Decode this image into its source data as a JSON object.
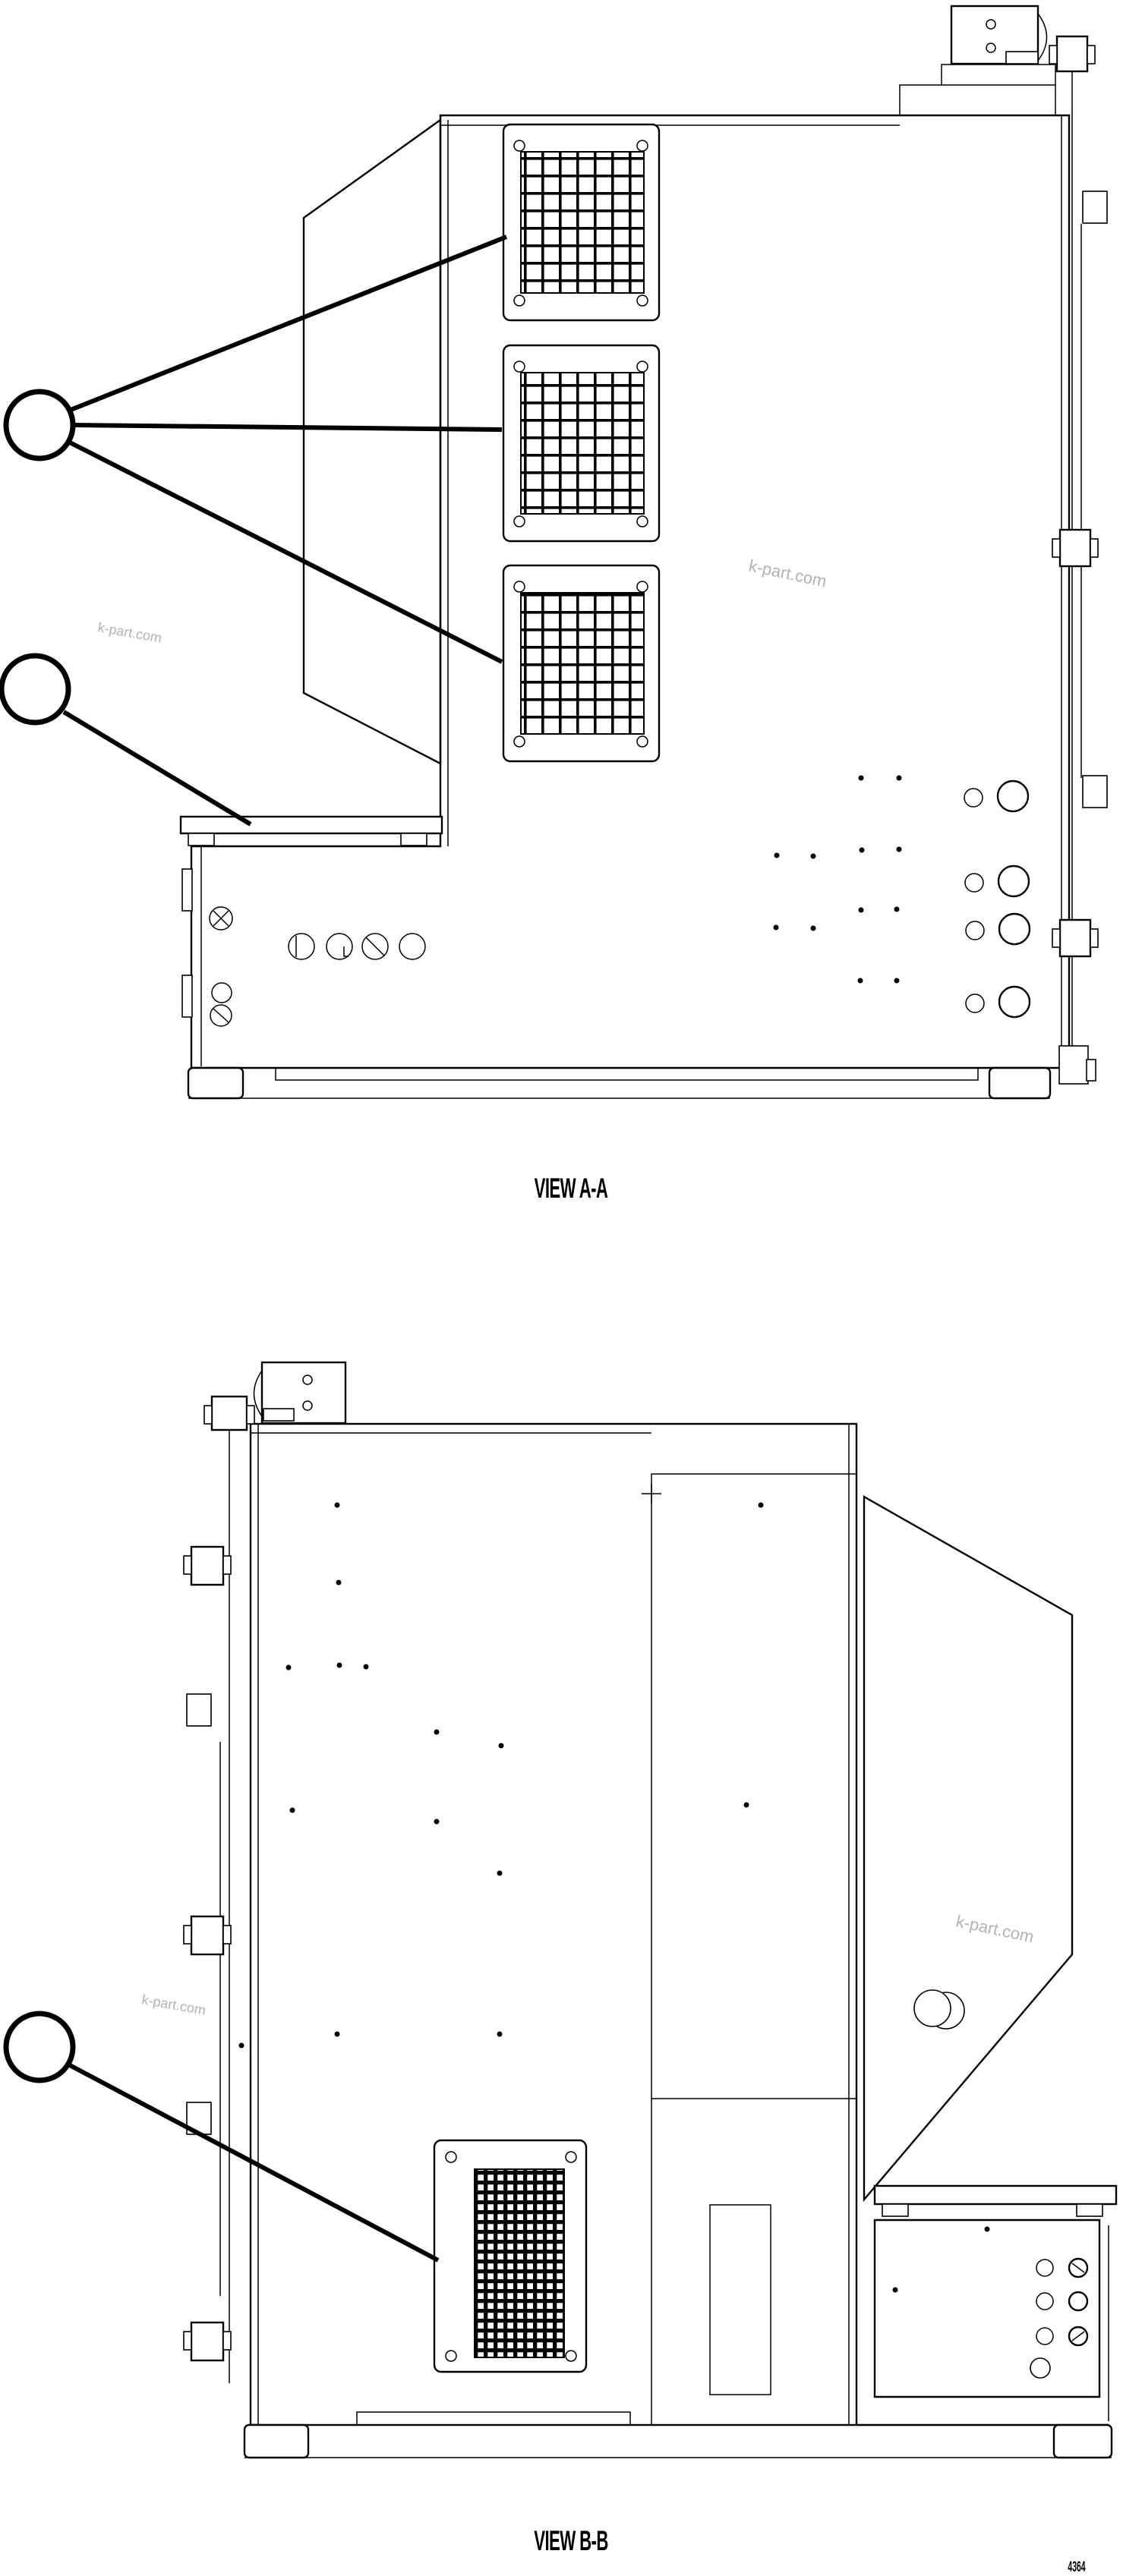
{
  "page": {
    "background": "#ffffff",
    "line_color": "#000000",
    "watermark": {
      "text": "k-part.com",
      "color": "#b3b3b3"
    },
    "page_number": "4364"
  },
  "views": {
    "a": {
      "label": "VIEW A-A",
      "balloons": [
        {
          "label": "",
          "leader_count": 3,
          "points_to": "vent-grilles"
        },
        {
          "label": "",
          "leader_count": 1,
          "points_to": "mounting-shelf"
        }
      ]
    },
    "b": {
      "label": "VIEW B-B",
      "balloons": [
        {
          "label": "",
          "leader_count": 1,
          "points_to": "vent-grille"
        }
      ]
    }
  }
}
